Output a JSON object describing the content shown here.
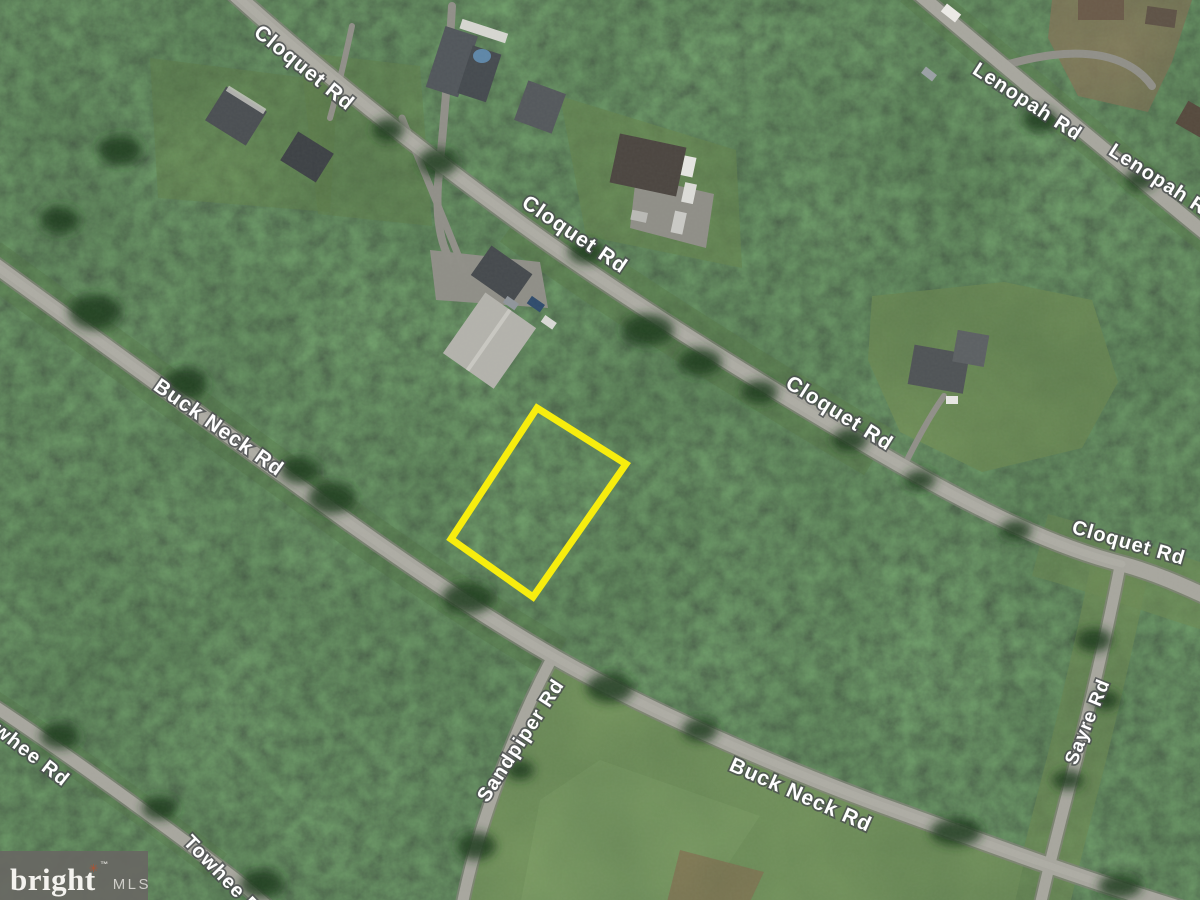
{
  "roads": {
    "cloquet": {
      "label": "Cloquet Rd"
    },
    "lenopah": {
      "label": "Lenopah Rd"
    },
    "buck_neck": {
      "label": "Buck Neck Rd"
    },
    "sandpiper": {
      "label": "Sandpiper Rd"
    },
    "sayre": {
      "label": "Sayre Rd"
    },
    "towhee": {
      "label": "Towhee Rd"
    }
  },
  "parcel": {
    "outline_color": "#f7ed0e"
  },
  "watermark": {
    "brand": "bright",
    "trademark_symbol": "™",
    "suffix": "MLS"
  }
}
